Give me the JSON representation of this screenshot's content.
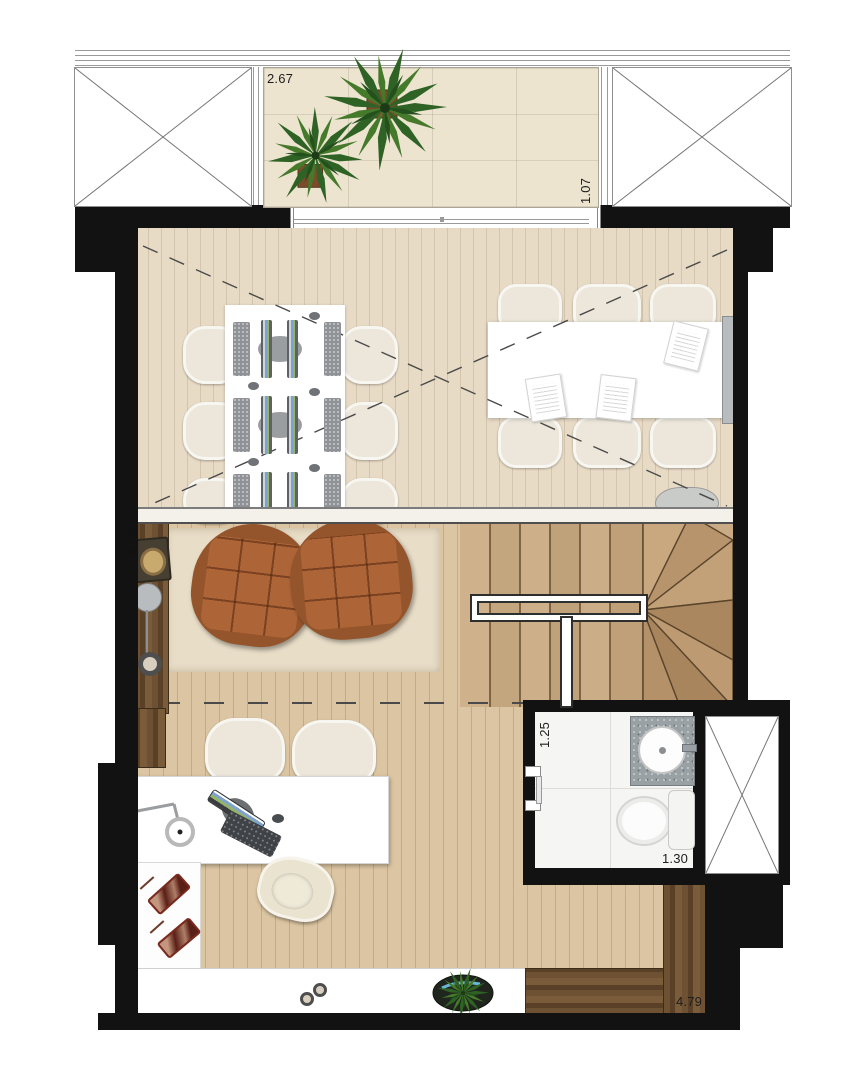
{
  "floorplan": {
    "title": "duplex-upper-floor-plan",
    "dimensions": {
      "terrace_width_label": "2.67",
      "terrace_depth_label": "1.07",
      "lounge_width_label": "4.15",
      "bathroom_width_label": "1.25",
      "bathroom_depth_label": "1.30",
      "studio_width_label": "4.79"
    },
    "colors": {
      "wall": "#121212",
      "office_floor": "#e8dbc6",
      "lounge_floor": "#dcc5a2",
      "terrace_tile": "#ede4d0",
      "rug": "#e8ddc7",
      "armchair_leather": "#ad6437",
      "dark_wood": "#6b4e31",
      "seat_fabric": "#ece7da",
      "vanity_granite": "#9aa1a5",
      "stair_wood": "#c9ac86",
      "handrail": "#ffffff"
    },
    "areas": [
      "terrace",
      "mezzanine-office",
      "lounge",
      "winder-staircase",
      "bathroom",
      "studio-desk-area",
      "void-left",
      "void-right",
      "duct-shaft"
    ],
    "icons": [
      "palm-plant-icon",
      "potted-plant-icon",
      "floor-lamp-icon",
      "candle-tray-icon",
      "desk-lamp-icon",
      "monitor-icon",
      "keyboard-icon",
      "mouse-icon",
      "document-icon",
      "sink-icon",
      "toilet-icon",
      "bowl-icon",
      "decor-tray-icon"
    ]
  }
}
